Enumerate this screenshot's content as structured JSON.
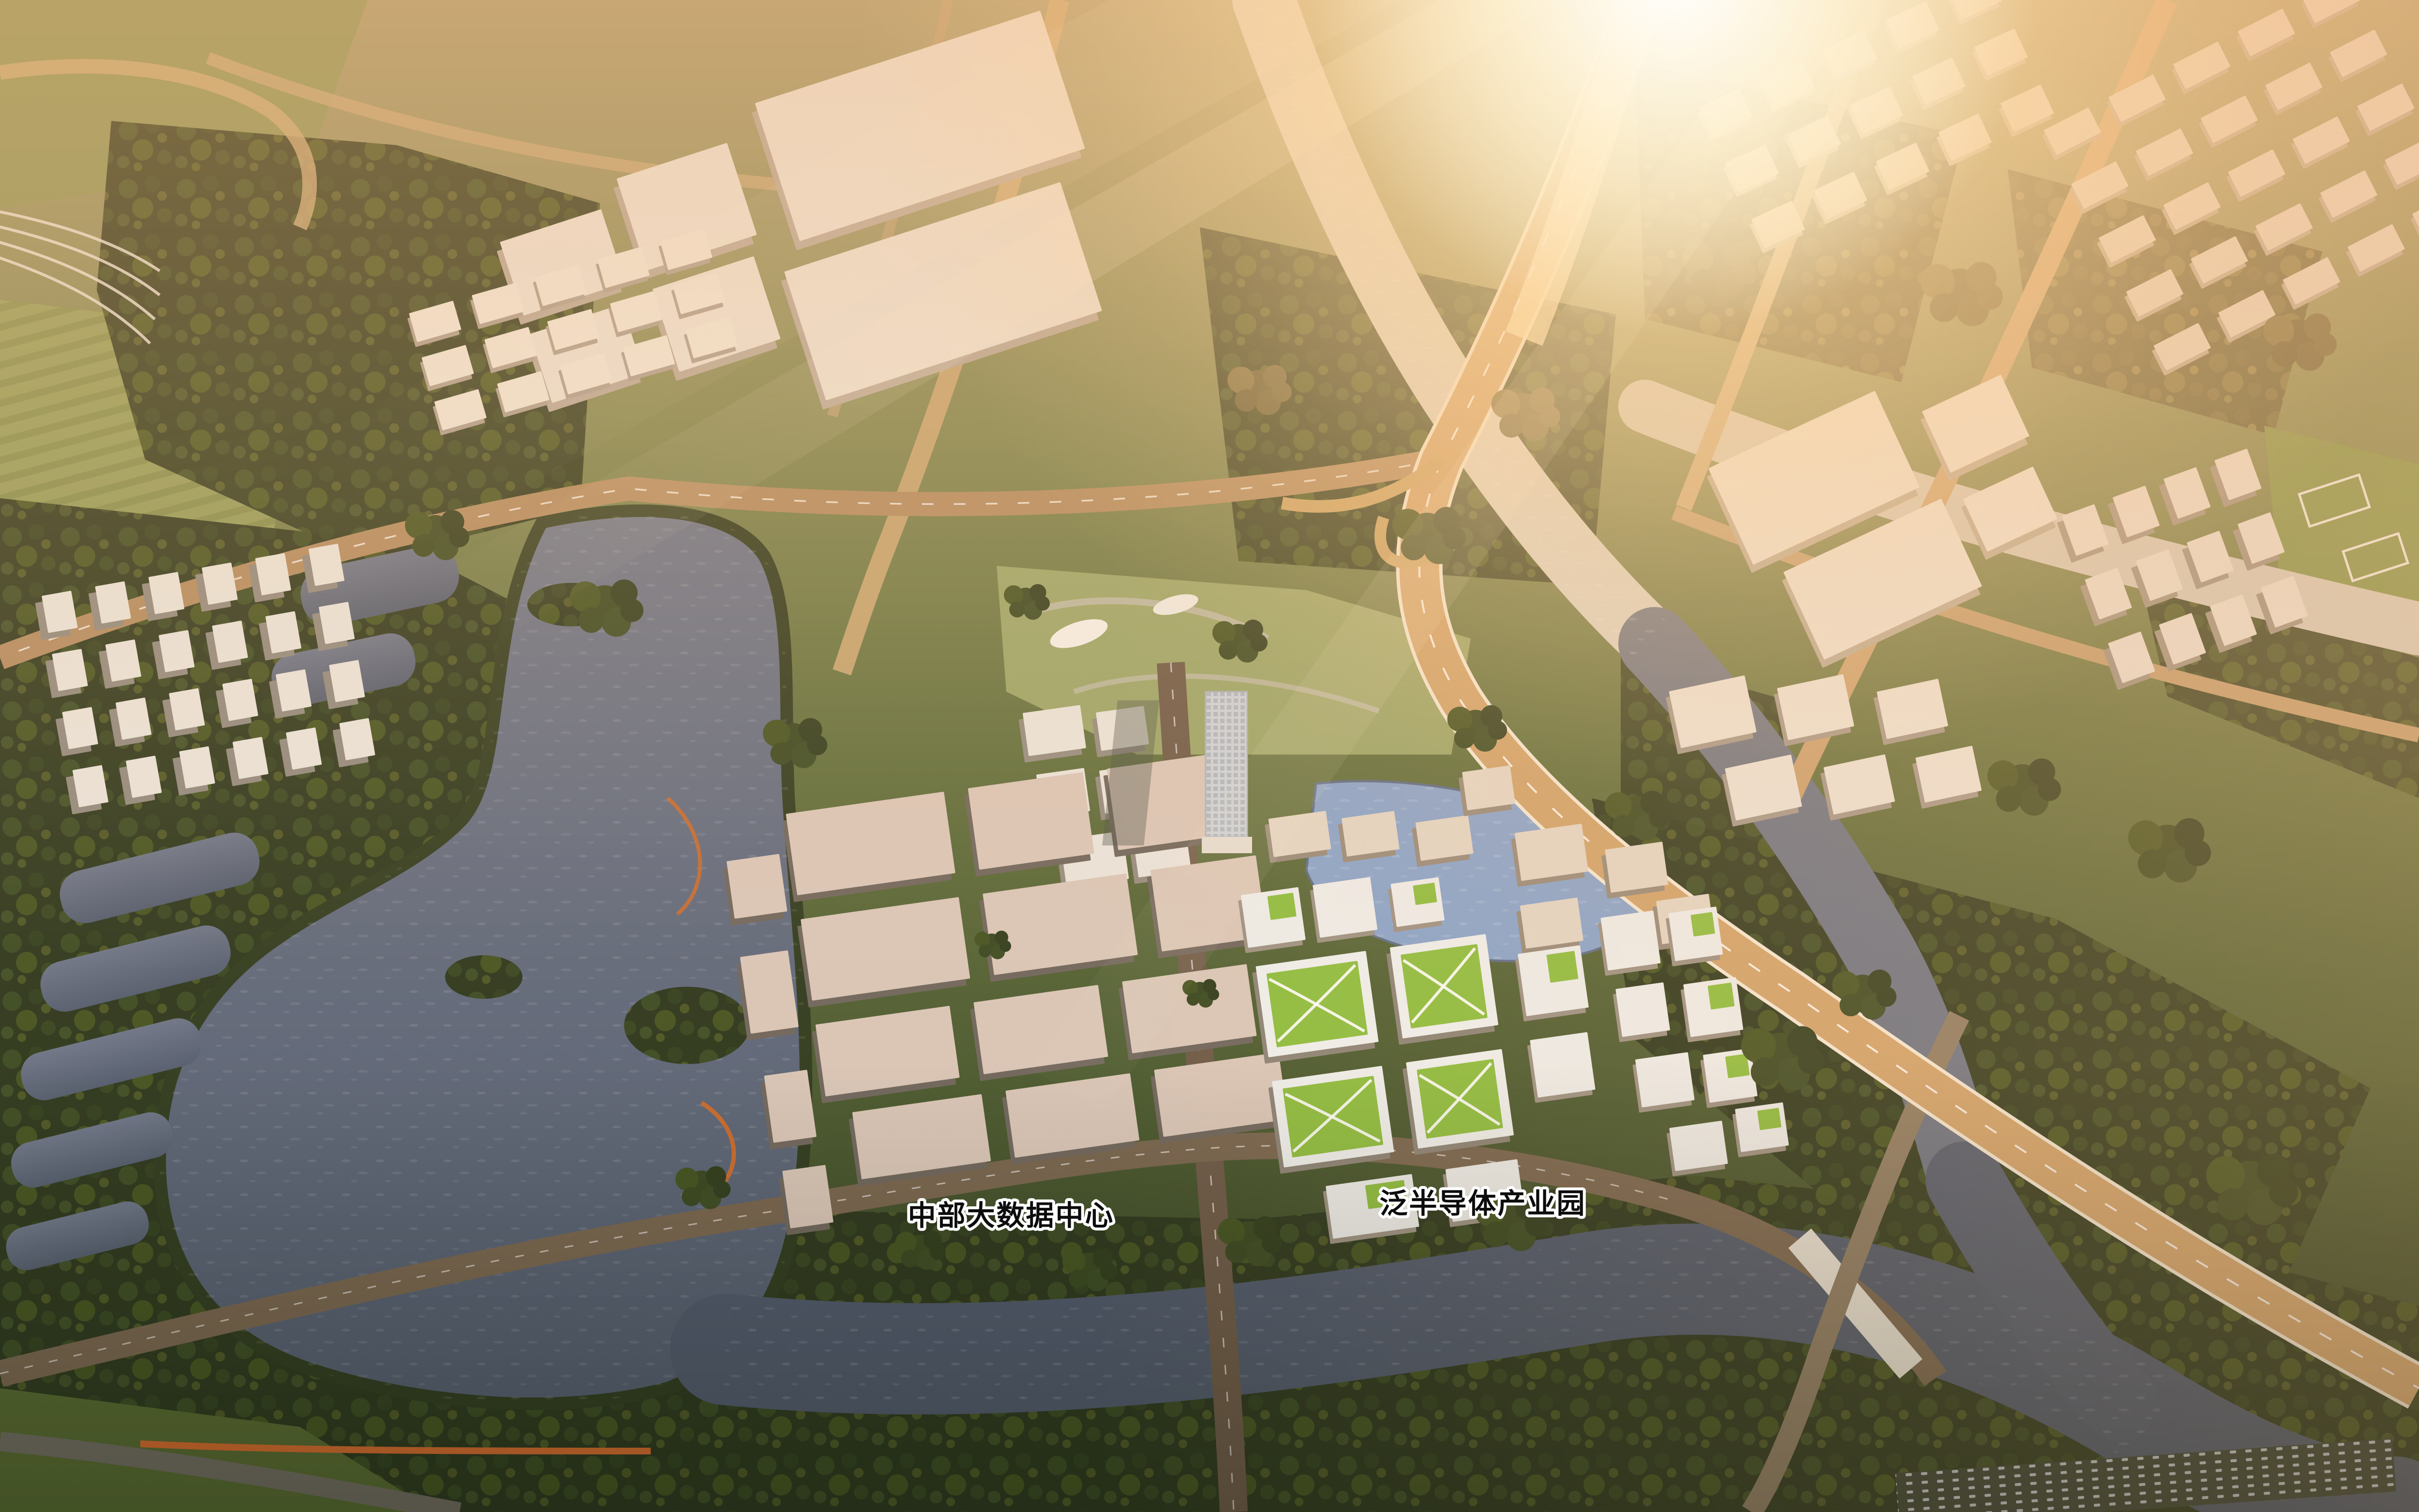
{
  "scene": {
    "kind": "aerial architectural rendering",
    "time_of_day": "golden hour / sunset",
    "view": "bird's-eye view of a planned riverside technology district with lake, elevated expressway and industrial campuses"
  },
  "labels": {
    "data_center": {
      "text": "中部大数据中心"
    },
    "semiconductor_park": {
      "text": "泛半导体产业园"
    }
  },
  "label_style": {
    "fill": "#0c0c0c",
    "outline": "#ffffff"
  },
  "palette": {
    "sun_glow": "#ffeccb",
    "haze_warm": "#ffb97c",
    "water_dark": "#535d70",
    "water_glint": "#d8d2c4",
    "pond_blue": "#87a3cb",
    "forest_dark": "#2b361c",
    "grass_light": "#7d8550",
    "road_sunlit": "#d3a873",
    "road_shaded": "#6f5c49",
    "building_white": "#ece7df",
    "warehouse_roof": "#d9c6b8",
    "green_roof": "#8cbd3e",
    "bridge_orange": "#d2682b"
  }
}
